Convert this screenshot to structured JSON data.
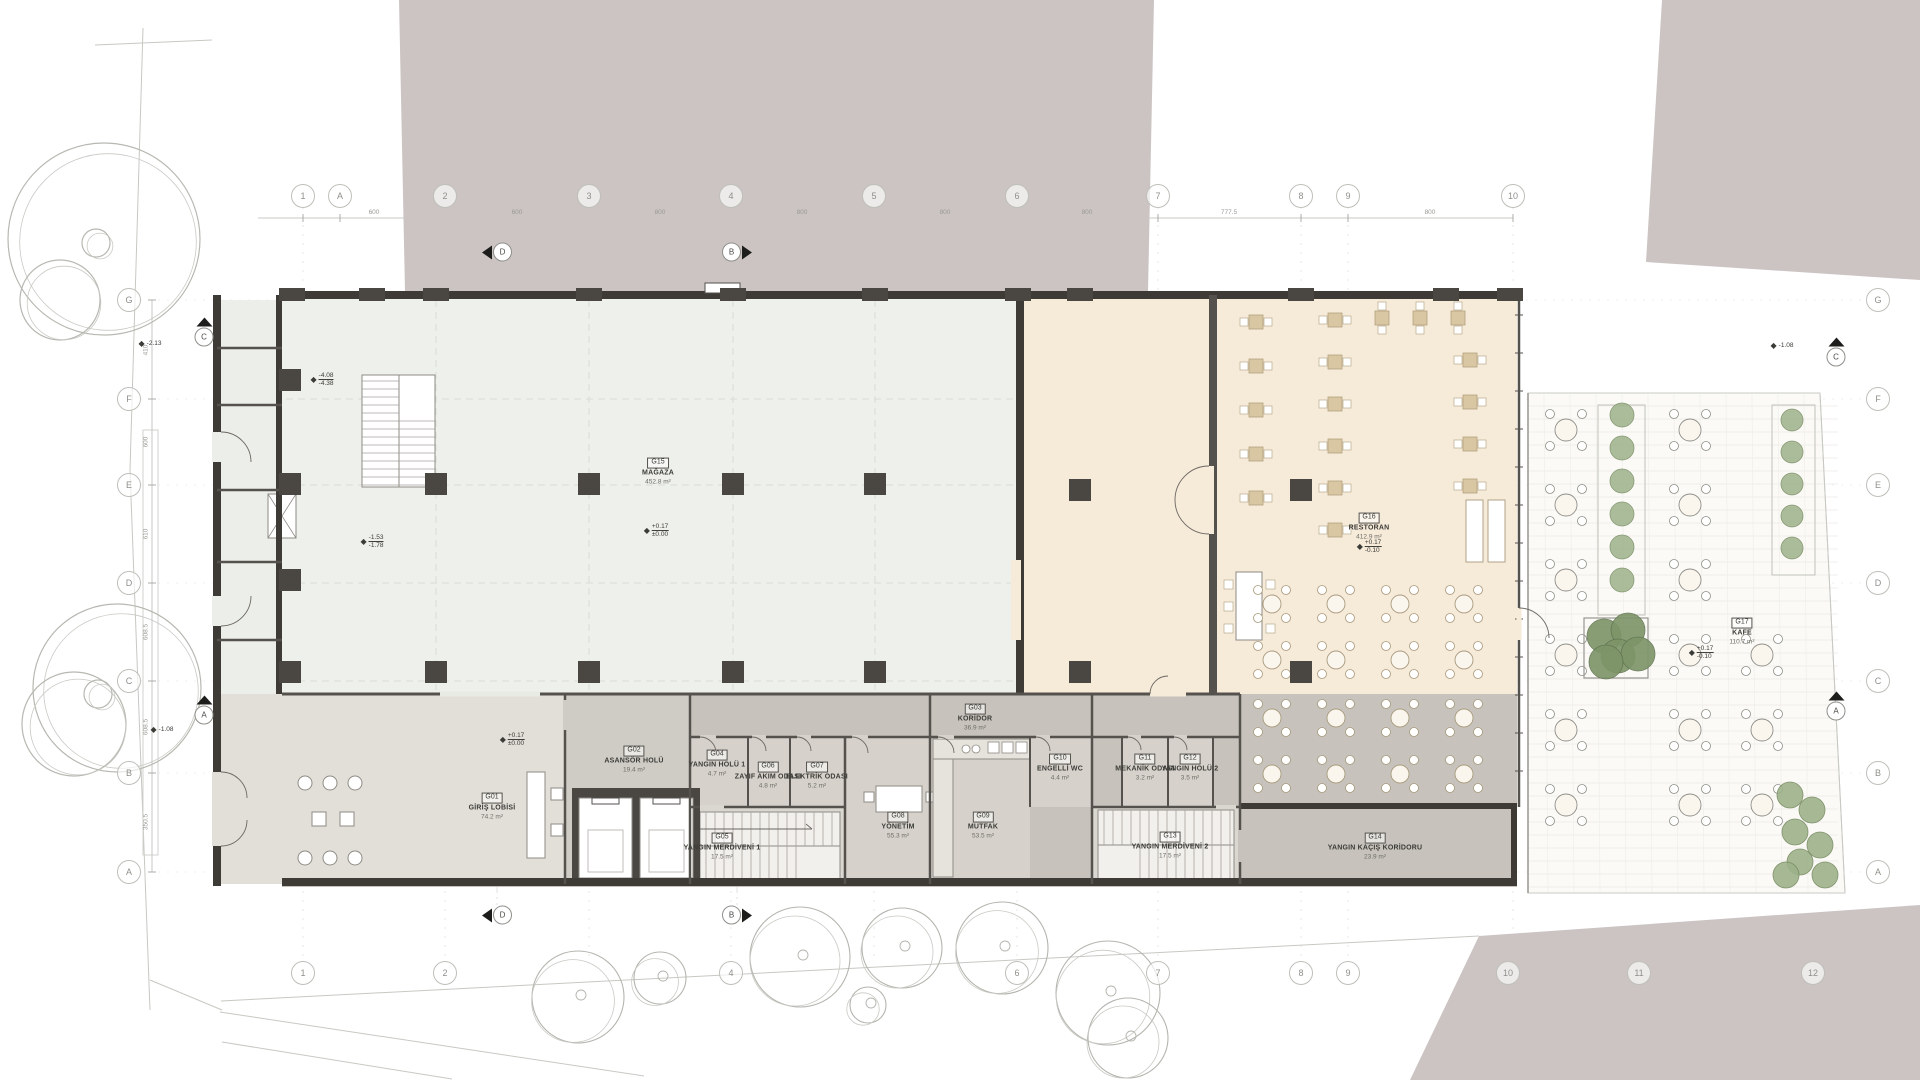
{
  "colors": {
    "background": "#ffffff",
    "neighbor_mass": "#cbc4c3",
    "store_floor": "#eef0ec",
    "restaurant_floor": "#f6ead9",
    "service_floor": "#c7c3bc",
    "room_floor": "#d6d2cb",
    "lobby_floor": "#e2dfd8",
    "terrace_floor": "#fbfaf7",
    "wall": "#3e3b37",
    "column": "#4a4641",
    "table_tan": "#d9c7a4",
    "green_dark": "#7d9468",
    "green_light": "#9db28a",
    "line_light": "#c6c6c1",
    "text": "#3b3b37"
  },
  "rooms": [
    {
      "code": "G01",
      "name": "GİRİŞ LOBİSİ",
      "area": "74.2 m²",
      "x": 492,
      "y": 803
    },
    {
      "code": "G02",
      "name": "ASANSÖR HOLÜ",
      "area": "19.4 m²",
      "x": 634,
      "y": 756
    },
    {
      "code": "G03",
      "name": "KORİDOR",
      "area": "36.9 m²",
      "x": 975,
      "y": 714
    },
    {
      "code": "G04",
      "name": "YANGIN HOLÜ 1",
      "area": "4.7 m²",
      "x": 717,
      "y": 760
    },
    {
      "code": "G05",
      "name": "YANGIN MERDİVENİ 1",
      "area": "17.5 m²",
      "x": 722,
      "y": 843
    },
    {
      "code": "G06",
      "name": "ZAYIF AKIM ODASI",
      "area": "4.8 m²",
      "x": 768,
      "y": 772
    },
    {
      "code": "G07",
      "name": "ELEKTRİK ODASI",
      "area": "5.2 m²",
      "x": 817,
      "y": 772
    },
    {
      "code": "G08",
      "name": "YÖNETİM",
      "area": "55.3 m²",
      "x": 898,
      "y": 822
    },
    {
      "code": "G09",
      "name": "MUTFAK",
      "area": "53.5 m²",
      "x": 983,
      "y": 822
    },
    {
      "code": "G10",
      "name": "ENGELLİ WC",
      "area": "4.4 m²",
      "x": 1060,
      "y": 764
    },
    {
      "code": "G11",
      "name": "MEKANİK ODASI",
      "area": "3.2 m²",
      "x": 1145,
      "y": 764
    },
    {
      "code": "G12",
      "name": "YANGIN HOLÜ 2",
      "area": "3.5 m²",
      "x": 1190,
      "y": 764
    },
    {
      "code": "G13",
      "name": "YANGIN MERDİVENİ 2",
      "area": "17.5 m²",
      "x": 1170,
      "y": 842
    },
    {
      "code": "G14",
      "name": "YANGIN KAÇIŞ KORİDORU",
      "area": "23.9 m²",
      "x": 1375,
      "y": 843
    },
    {
      "code": "G15",
      "name": "MAĞAZA",
      "area": "452.8 m²",
      "x": 658,
      "y": 468
    },
    {
      "code": "G16",
      "name": "RESTORAN",
      "area": "412.9 m²",
      "x": 1369,
      "y": 523
    },
    {
      "code": "G17",
      "name": "KAFE",
      "area": "110.7 m²",
      "x": 1742,
      "y": 628
    }
  ],
  "grid": {
    "top": {
      "y": 196,
      "items": [
        {
          "label": "1",
          "x": 303
        },
        {
          "label": "A",
          "x": 340
        },
        {
          "label": "2",
          "x": 445
        },
        {
          "label": "3",
          "x": 589
        },
        {
          "label": "4",
          "x": 731
        },
        {
          "label": "5",
          "x": 874
        },
        {
          "label": "6",
          "x": 1017
        },
        {
          "label": "7",
          "x": 1158
        },
        {
          "label": "8",
          "x": 1301
        },
        {
          "label": "9",
          "x": 1348
        },
        {
          "label": "10",
          "x": 1513
        }
      ]
    },
    "bottom": {
      "y": 973,
      "items": [
        {
          "label": "1",
          "x": 303
        },
        {
          "label": "2",
          "x": 445
        },
        {
          "label": "4",
          "x": 731
        },
        {
          "label": "6",
          "x": 1017
        },
        {
          "label": "7",
          "x": 1158
        },
        {
          "label": "8",
          "x": 1301
        },
        {
          "label": "9",
          "x": 1348
        },
        {
          "label": "10",
          "x": 1508
        },
        {
          "label": "11",
          "x": 1639
        },
        {
          "label": "12",
          "x": 1813
        }
      ]
    },
    "left": {
      "x": 129,
      "items": [
        {
          "label": "G",
          "y": 300
        },
        {
          "label": "F",
          "y": 399
        },
        {
          "label": "E",
          "y": 485
        },
        {
          "label": "D",
          "y": 583
        },
        {
          "label": "C",
          "y": 681
        },
        {
          "label": "B",
          "y": 773
        },
        {
          "label": "A",
          "y": 872
        }
      ]
    },
    "right": {
      "x": 1878,
      "items": [
        {
          "label": "G",
          "y": 300
        },
        {
          "label": "F",
          "y": 399
        },
        {
          "label": "E",
          "y": 485
        },
        {
          "label": "D",
          "y": 583
        },
        {
          "label": "C",
          "y": 681
        },
        {
          "label": "B",
          "y": 773
        },
        {
          "label": "A",
          "y": 872
        }
      ]
    }
  },
  "dimensions": {
    "top": [
      {
        "x": 374,
        "v": "600"
      },
      {
        "x": 517,
        "v": "600"
      },
      {
        "x": 660,
        "v": "800"
      },
      {
        "x": 802,
        "v": "800"
      },
      {
        "x": 945,
        "v": "800"
      },
      {
        "x": 1087,
        "v": "800"
      },
      {
        "x": 1229,
        "v": "777.5"
      },
      {
        "x": 1430,
        "v": "800"
      }
    ],
    "left": [
      {
        "y": 350,
        "v": "410"
      },
      {
        "y": 442,
        "v": "600"
      },
      {
        "y": 534,
        "v": "610"
      },
      {
        "y": 632,
        "v": "608.5"
      },
      {
        "y": 727,
        "v": "608.5"
      },
      {
        "y": 822,
        "v": "350.5"
      }
    ]
  },
  "elevations": [
    {
      "x": 150,
      "y": 344,
      "lines": [
        "-2.13"
      ]
    },
    {
      "x": 162,
      "y": 730,
      "lines": [
        "-1.08"
      ]
    },
    {
      "x": 322,
      "y": 380,
      "lines": [
        "-4.08",
        "-4.38"
      ]
    },
    {
      "x": 372,
      "y": 542,
      "lines": [
        "-1.53",
        "-1.78"
      ]
    },
    {
      "x": 656,
      "y": 531,
      "lines": [
        "+0.17",
        "±0.00"
      ]
    },
    {
      "x": 512,
      "y": 740,
      "lines": [
        "+0.17",
        "±0.00"
      ]
    },
    {
      "x": 1369,
      "y": 547,
      "lines": [
        "+0.17",
        "-0.10"
      ]
    },
    {
      "x": 1701,
      "y": 653,
      "lines": [
        "+0.17",
        "-0.10"
      ]
    },
    {
      "x": 1782,
      "y": 346,
      "lines": [
        "-1.08"
      ]
    }
  ],
  "sections": [
    {
      "label": "D",
      "x": 497,
      "y": 252,
      "dir": "left"
    },
    {
      "label": "B",
      "x": 737,
      "y": 252,
      "dir": "right"
    },
    {
      "label": "D",
      "x": 497,
      "y": 915,
      "dir": "left"
    },
    {
      "label": "B",
      "x": 737,
      "y": 915,
      "dir": "right"
    },
    {
      "label": "C",
      "x": 204,
      "y": 332,
      "dir": "up"
    },
    {
      "label": "A",
      "x": 204,
      "y": 710,
      "dir": "up"
    },
    {
      "label": "C",
      "x": 1836,
      "y": 352,
      "dir": "up"
    },
    {
      "label": "A",
      "x": 1836,
      "y": 706,
      "dir": "up"
    }
  ]
}
